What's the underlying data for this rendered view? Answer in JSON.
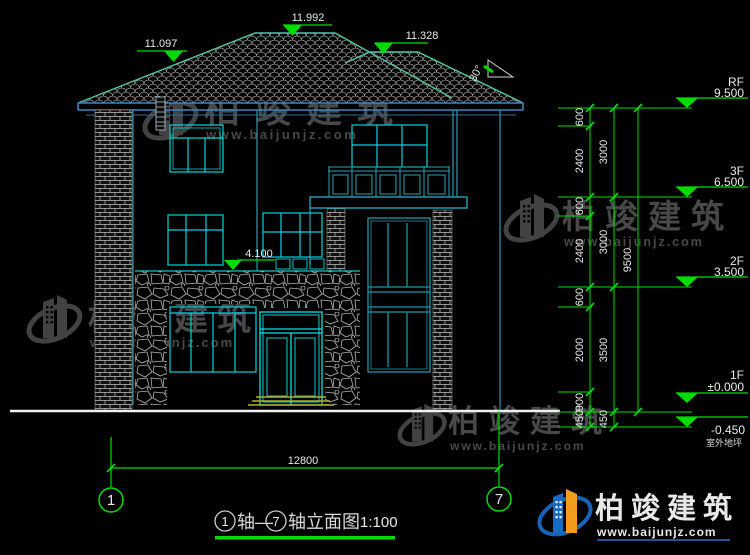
{
  "watermark": {
    "brand": "柏竣建筑",
    "site": "www.baijunjz.com"
  },
  "footer": {
    "brand": "柏竣建筑",
    "site": "www.baijunjz.com"
  },
  "roof": {
    "dim_left": "11.097",
    "dim_ridge": "11.992",
    "dim_right": "11.328",
    "slope": "30°"
  },
  "levels": {
    "rf": {
      "label": "RF",
      "value": "9.500"
    },
    "f3": {
      "label": "3F",
      "value": "6.500"
    },
    "f2": {
      "label": "2F",
      "value": "3.500"
    },
    "f1": {
      "label": "1F",
      "value": "±0.000"
    },
    "ground": {
      "value": "-0.450",
      "label": "室外地坪"
    },
    "ledge": "4.100"
  },
  "vdims": {
    "inner": [
      "600",
      "2400",
      "600",
      "2400",
      "600",
      "2000",
      "900",
      "450"
    ],
    "mid": [
      "3000",
      "3000",
      "3500",
      "450"
    ],
    "outer": [
      "9500"
    ]
  },
  "axes": {
    "left": "1",
    "right": "7",
    "overall": "12800"
  },
  "title": {
    "axis_left": "1",
    "axis_right": "7",
    "seg1": "轴—",
    "seg2": "轴立面图",
    "scale": "1:100"
  }
}
